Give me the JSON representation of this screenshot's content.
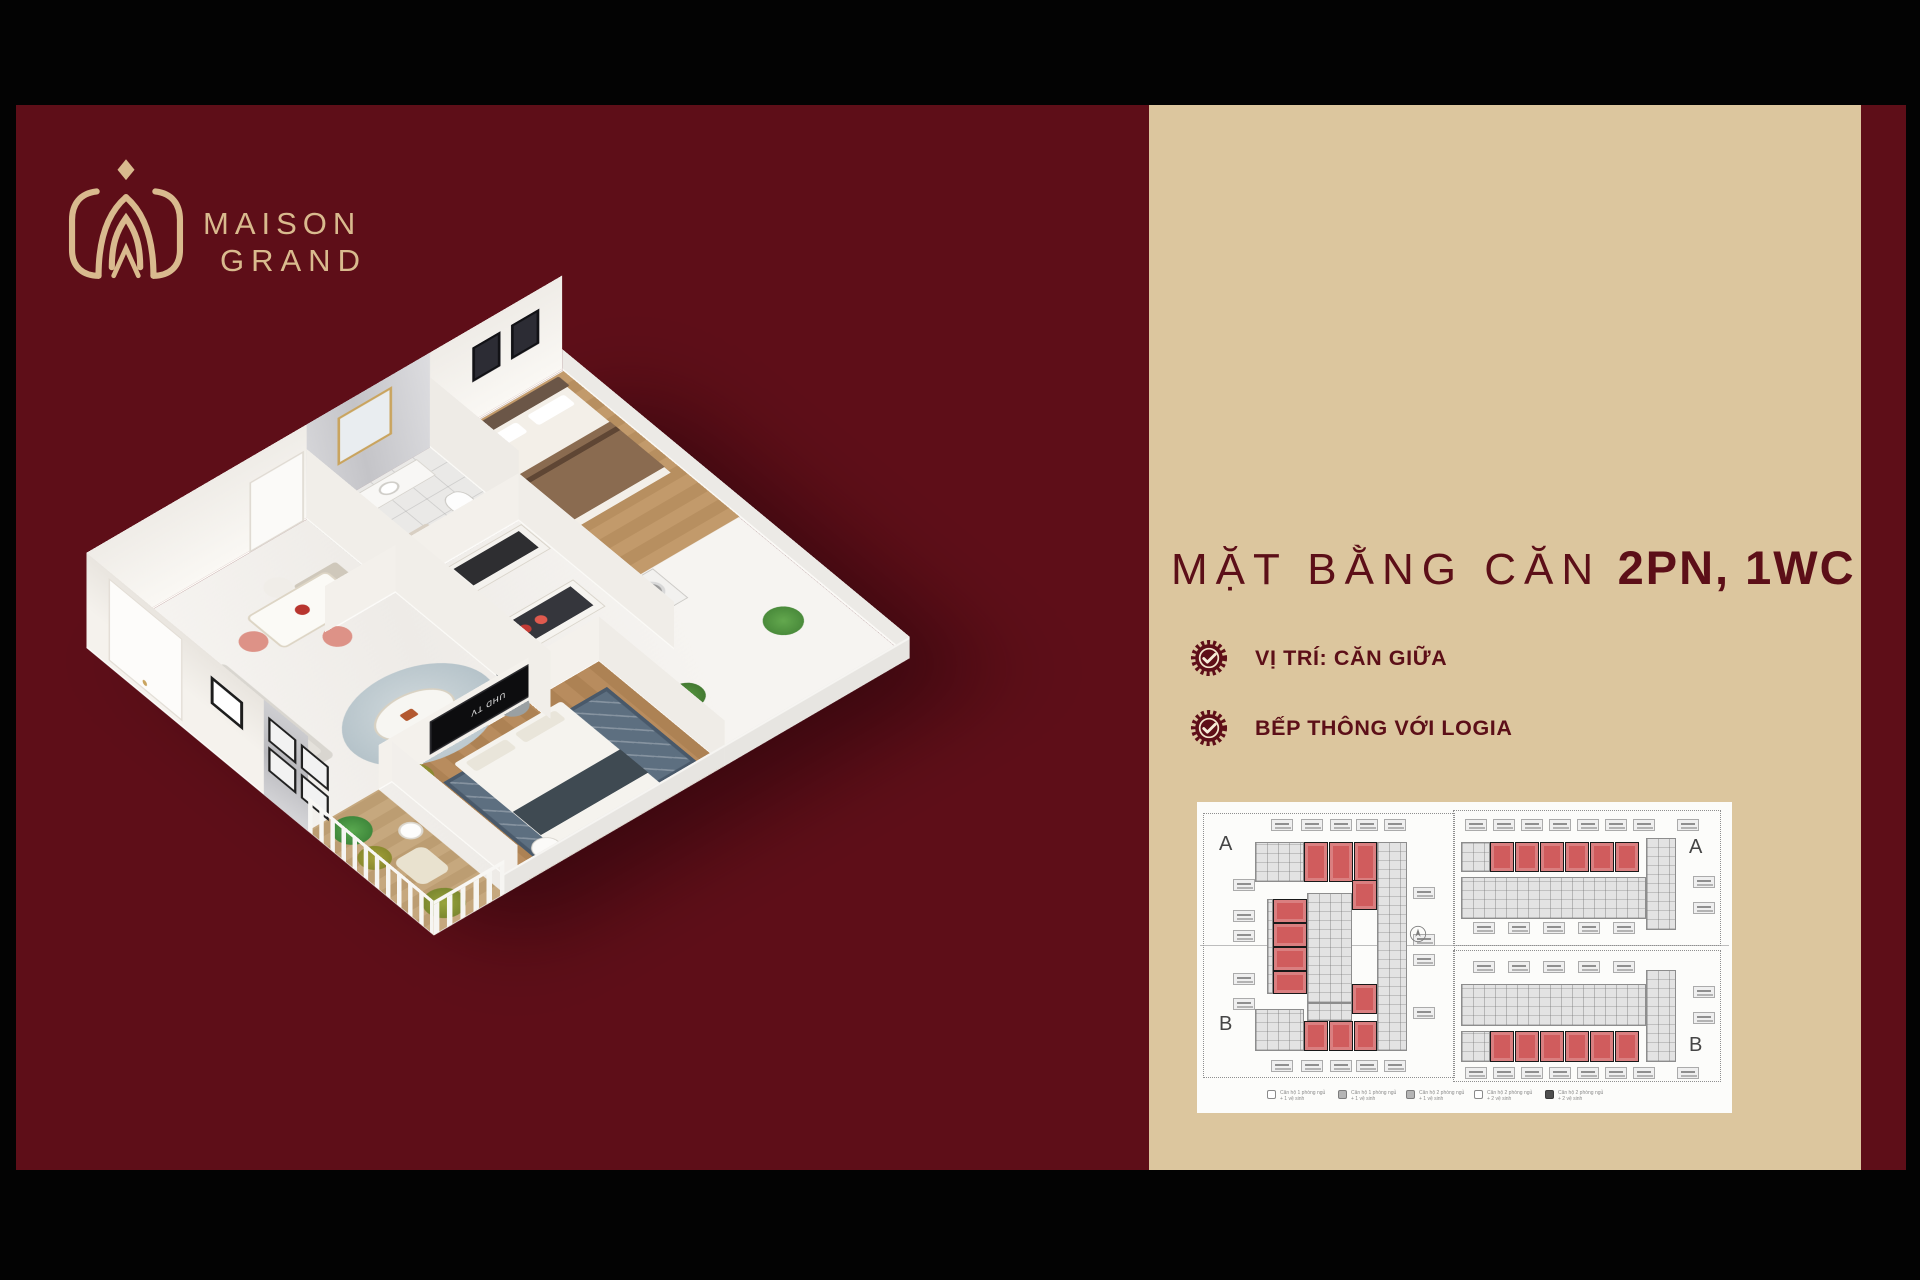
{
  "colors": {
    "frame_black": "#030303",
    "maroon": "#5e0e18",
    "tan_panel": "#dcc69e",
    "gold": "#d9ba8e",
    "title_red": "#5c0f18",
    "red_unit": "#d05c5d"
  },
  "logo": {
    "line1": "MAISON",
    "line2": "GRAND"
  },
  "headline": {
    "light": "MẶT BẰNG CĂN",
    "bold": "2PN, 1WC"
  },
  "features": [
    {
      "label": "VỊ TRÍ: CĂN GIỮA"
    },
    {
      "label": "BẾP THÔNG VỚI LOGIA"
    }
  ],
  "render3d": {
    "tv_label": "UHD TV"
  },
  "floorplan": {
    "towers": [
      {
        "name": "tower-left",
        "box": {
          "x": 6,
          "y": 11,
          "w": 252,
          "h": 265
        },
        "dotted": [
          {
            "x": 0,
            "y": 0,
            "w": 252,
            "h": 265
          }
        ],
        "labels": [
          {
            "t": "A",
            "x": 16,
            "y": 20
          },
          {
            "t": "B",
            "x": 16,
            "y": 200
          }
        ],
        "red": [
          {
            "x": 101,
            "y": 29,
            "w": 24,
            "h": 40
          },
          {
            "x": 126,
            "y": 29,
            "w": 24,
            "h": 40
          },
          {
            "x": 151,
            "y": 29,
            "w": 23,
            "h": 40
          },
          {
            "x": 149,
            "y": 67,
            "w": 25,
            "h": 30
          },
          {
            "x": 70,
            "y": 86,
            "w": 34,
            "h": 24
          },
          {
            "x": 70,
            "y": 110,
            "w": 34,
            "h": 24
          },
          {
            "x": 70,
            "y": 134,
            "w": 34,
            "h": 24
          },
          {
            "x": 70,
            "y": 158,
            "w": 34,
            "h": 23
          },
          {
            "x": 149,
            "y": 171,
            "w": 25,
            "h": 30
          },
          {
            "x": 101,
            "y": 208,
            "w": 24,
            "h": 30
          },
          {
            "x": 126,
            "y": 208,
            "w": 24,
            "h": 30
          },
          {
            "x": 151,
            "y": 208,
            "w": 23,
            "h": 30
          }
        ],
        "gray": [
          {
            "x": 52,
            "y": 29,
            "w": 49,
            "h": 40
          },
          {
            "x": 174,
            "y": 29,
            "w": 30,
            "h": 209
          },
          {
            "x": 104,
            "y": 80,
            "w": 45,
            "h": 110
          },
          {
            "x": 52,
            "y": 196,
            "w": 49,
            "h": 42
          },
          {
            "x": 64,
            "y": 86,
            "w": 6,
            "h": 95
          },
          {
            "x": 104,
            "y": 190,
            "w": 45,
            "h": 18
          }
        ],
        "callouts": [
          {
            "x": 68,
            "y": 6
          },
          {
            "x": 98,
            "y": 6
          },
          {
            "x": 127,
            "y": 6
          },
          {
            "x": 153,
            "y": 6
          },
          {
            "x": 181,
            "y": 6
          },
          {
            "x": 68,
            "y": 247
          },
          {
            "x": 98,
            "y": 247
          },
          {
            "x": 127,
            "y": 247
          },
          {
            "x": 153,
            "y": 247
          },
          {
            "x": 181,
            "y": 247
          },
          {
            "x": 30,
            "y": 66
          },
          {
            "x": 30,
            "y": 97
          },
          {
            "x": 30,
            "y": 117
          },
          {
            "x": 30,
            "y": 160
          },
          {
            "x": 30,
            "y": 185
          },
          {
            "x": 210,
            "y": 74
          },
          {
            "x": 210,
            "y": 121
          },
          {
            "x": 210,
            "y": 141
          },
          {
            "x": 210,
            "y": 194
          }
        ],
        "north": {
          "x": 206,
          "y": 112
        }
      },
      {
        "name": "tower-right",
        "box": {
          "x": 256,
          "y": 8,
          "w": 268,
          "h": 272
        },
        "dotted": [
          {
            "x": 0,
            "y": 0,
            "w": 268,
            "h": 136
          },
          {
            "x": 0,
            "y": 140,
            "w": 268,
            "h": 132
          }
        ],
        "labels": [
          {
            "t": "A",
            "x": 236,
            "y": 26
          },
          {
            "t": "B",
            "x": 236,
            "y": 224
          }
        ],
        "red": [
          {
            "x": 37,
            "y": 32,
            "w": 24,
            "h": 30
          },
          {
            "x": 62,
            "y": 32,
            "w": 24,
            "h": 30
          },
          {
            "x": 87,
            "y": 32,
            "w": 24,
            "h": 30
          },
          {
            "x": 112,
            "y": 32,
            "w": 24,
            "h": 30
          },
          {
            "x": 137,
            "y": 32,
            "w": 24,
            "h": 30
          },
          {
            "x": 162,
            "y": 32,
            "w": 24,
            "h": 30
          },
          {
            "x": 37,
            "y": 221,
            "w": 24,
            "h": 31
          },
          {
            "x": 62,
            "y": 221,
            "w": 24,
            "h": 31
          },
          {
            "x": 87,
            "y": 221,
            "w": 24,
            "h": 31
          },
          {
            "x": 112,
            "y": 221,
            "w": 24,
            "h": 31
          },
          {
            "x": 137,
            "y": 221,
            "w": 24,
            "h": 31
          },
          {
            "x": 162,
            "y": 221,
            "w": 24,
            "h": 31
          }
        ],
        "gray": [
          {
            "x": 8,
            "y": 32,
            "w": 29,
            "h": 30
          },
          {
            "x": 8,
            "y": 67,
            "w": 185,
            "h": 42
          },
          {
            "x": 193,
            "y": 28,
            "w": 30,
            "h": 92
          },
          {
            "x": 8,
            "y": 174,
            "w": 185,
            "h": 42
          },
          {
            "x": 193,
            "y": 160,
            "w": 30,
            "h": 92
          },
          {
            "x": 8,
            "y": 221,
            "w": 29,
            "h": 31
          }
        ],
        "callouts": [
          {
            "x": 12,
            "y": 9
          },
          {
            "x": 40,
            "y": 9
          },
          {
            "x": 68,
            "y": 9
          },
          {
            "x": 96,
            "y": 9
          },
          {
            "x": 124,
            "y": 9
          },
          {
            "x": 152,
            "y": 9
          },
          {
            "x": 180,
            "y": 9
          },
          {
            "x": 224,
            "y": 9
          },
          {
            "x": 20,
            "y": 112
          },
          {
            "x": 55,
            "y": 112
          },
          {
            "x": 90,
            "y": 112
          },
          {
            "x": 125,
            "y": 112
          },
          {
            "x": 160,
            "y": 112
          },
          {
            "x": 240,
            "y": 66
          },
          {
            "x": 240,
            "y": 92
          },
          {
            "x": 20,
            "y": 151
          },
          {
            "x": 55,
            "y": 151
          },
          {
            "x": 90,
            "y": 151
          },
          {
            "x": 125,
            "y": 151
          },
          {
            "x": 160,
            "y": 151
          },
          {
            "x": 12,
            "y": 257
          },
          {
            "x": 40,
            "y": 257
          },
          {
            "x": 68,
            "y": 257
          },
          {
            "x": 96,
            "y": 257
          },
          {
            "x": 124,
            "y": 257
          },
          {
            "x": 152,
            "y": 257
          },
          {
            "x": 180,
            "y": 257
          },
          {
            "x": 224,
            "y": 257
          },
          {
            "x": 240,
            "y": 176
          },
          {
            "x": 240,
            "y": 202
          }
        ]
      }
    ],
    "legend": [
      {
        "swatch": "outline",
        "line1": "Căn hộ 1 phòng ngủ",
        "line2": "+ 1 vệ sinh",
        "x": 70
      },
      {
        "swatch": "gray",
        "line1": "Căn hộ 1 phòng ngủ",
        "line2": "+ 1 vệ sinh",
        "x": 141
      },
      {
        "swatch": "gray",
        "line1": "Căn hộ 2 phòng ngủ",
        "line2": "+ 1 vệ sinh",
        "x": 209
      },
      {
        "swatch": "outline",
        "line1": "Căn hộ 2 phòng ngủ",
        "line2": "+ 2 vệ sinh",
        "x": 277
      },
      {
        "swatch": "dark",
        "line1": "Căn hộ 2 phòng ngủ",
        "line2": "+ 2 vệ sinh",
        "x": 348
      }
    ]
  }
}
